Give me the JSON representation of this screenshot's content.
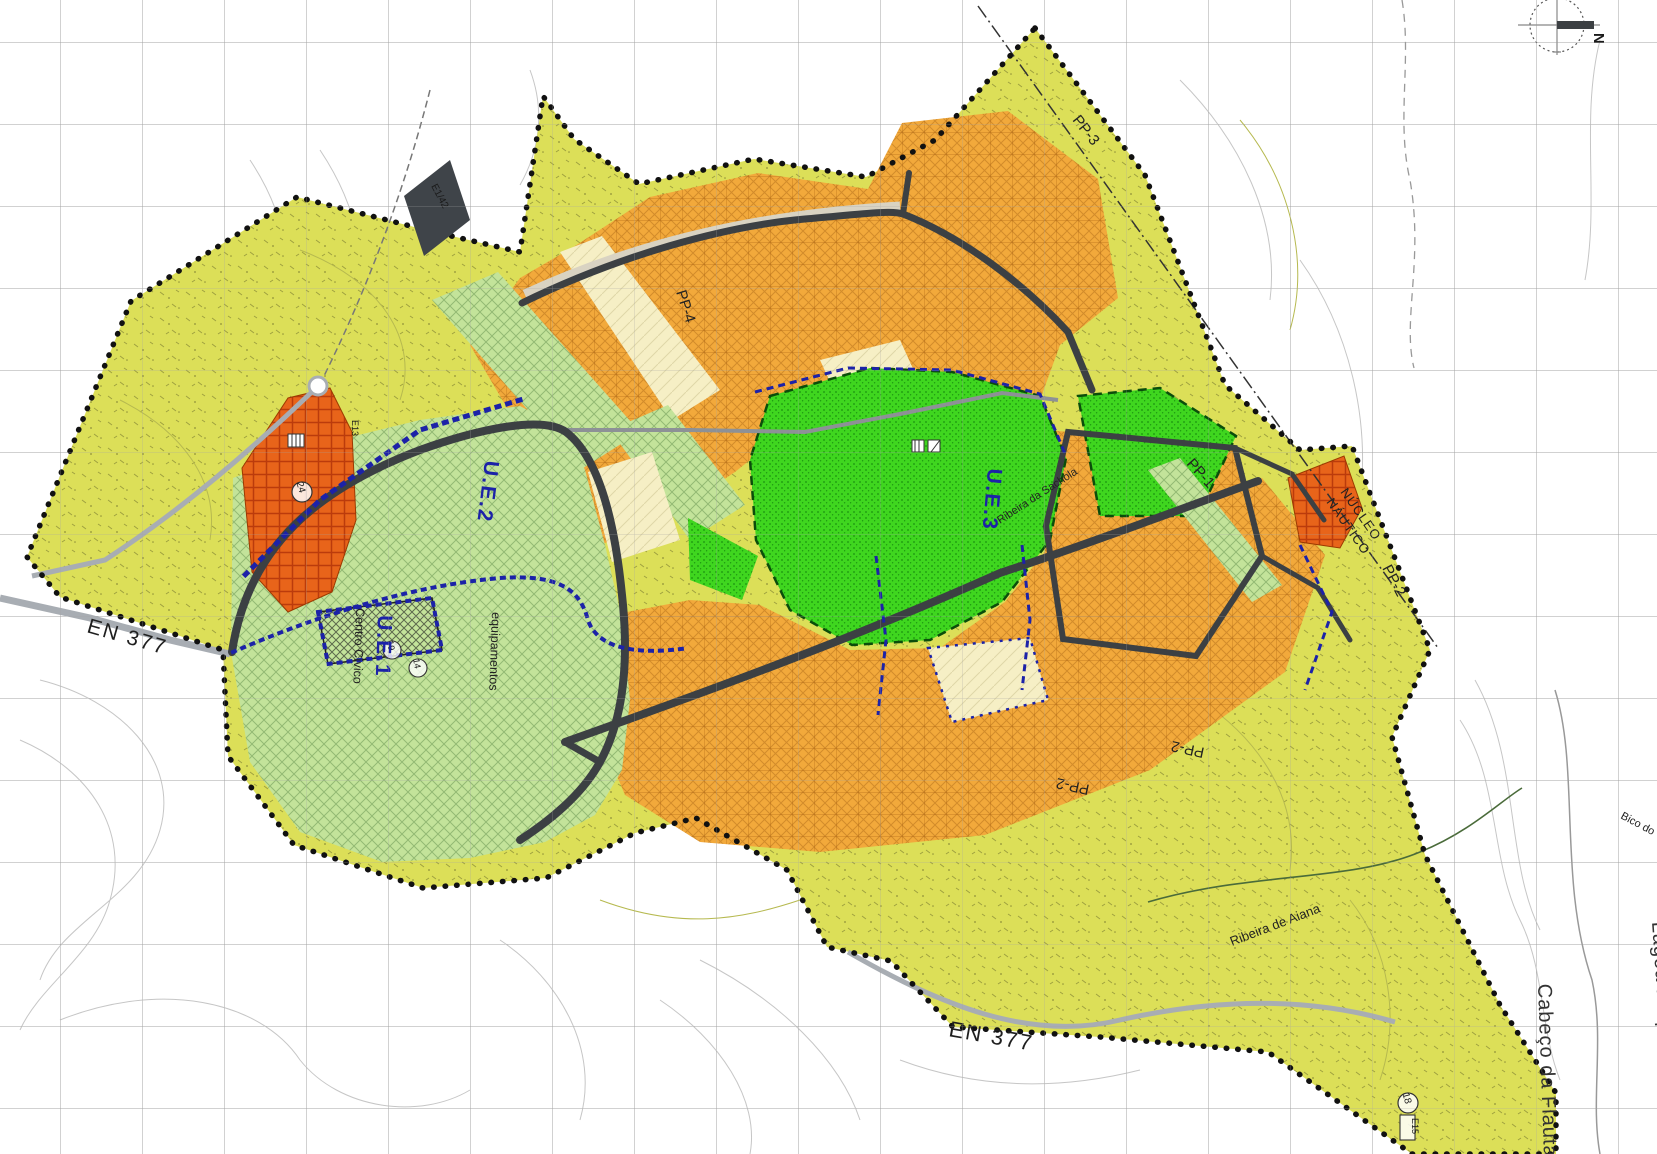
{
  "map": {
    "north": {
      "label": "N"
    },
    "flag": {
      "label": "E1/42"
    },
    "labels": {
      "en377_left": "EN 377",
      "en377_bottom": "EN 377",
      "ue1": "U.E.1",
      "ue2": "U.E.2",
      "ue3": "U.E.3",
      "centro_civico": "Centro Cívico",
      "equipamentos": "equipamentos",
      "pp1": "PP-1",
      "pp2": "PP-2",
      "pp2_inv_a": "PP-2",
      "pp2_inv_b": "PP-2",
      "pp3": "PP-3",
      "pp4": "PP-4",
      "nucleo_line1": "NÚCLEO",
      "nucleo_line2": "NÁUTICO",
      "ribeira_sachola": "Ribeira da Sachola",
      "ribeira_aiana": "Ribeira de Aiana",
      "lagoa_pequena": "Lagoa Pequena",
      "cabeco_flauta": "Cabeço da Flauta",
      "bico_do": "Bico do"
    },
    "markers": {
      "m24": "24",
      "m18": "18",
      "m14": "14",
      "m19": "19",
      "e15": "E15",
      "e13": "E13"
    },
    "zones": {
      "plan_area": "rural / plan area (olive)",
      "urban_orange": "urbanizable blocks (orange)",
      "park_green": "urban park (bright green)",
      "civic_light_green": "civic / equipment area (light green)",
      "reserve_cream": "reserve parcels (cream)",
      "special_red": "special use parcels (red-orange)"
    },
    "colors": {
      "olive": "#dcdf58",
      "orange": "#f2a93b",
      "bright_green": "#3fd61f",
      "light_green": "#c3e39a",
      "cream": "#f6efc5",
      "red_orange": "#e8641a",
      "road_dark": "#3c4043",
      "road_gray": "#a8adb3",
      "plan_blue": "#1c22a8",
      "boundary_black": "#111111",
      "grid_gray": "#a3a3a3",
      "park_boundary": "#0b4d0b",
      "contour_gray": "#c6c6c6"
    }
  }
}
